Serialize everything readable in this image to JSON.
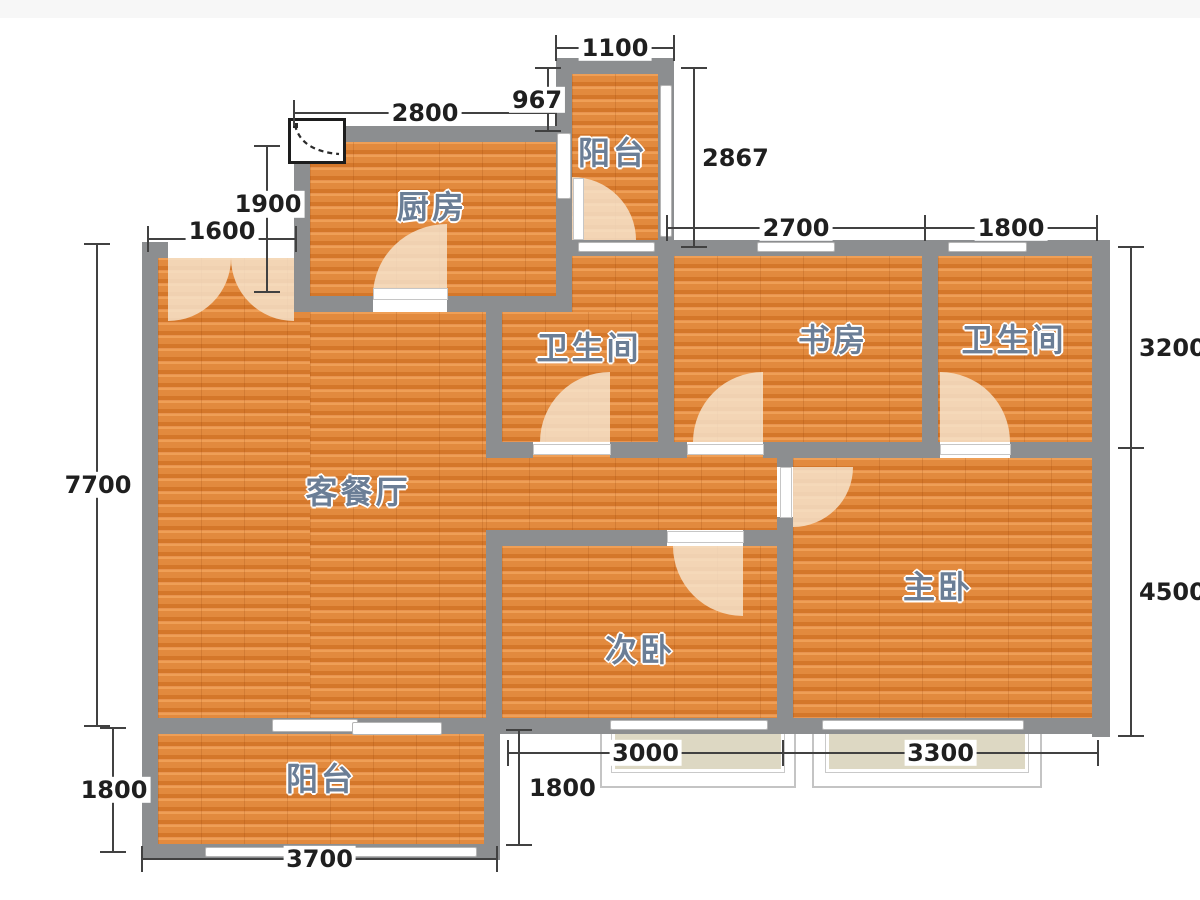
{
  "plan": {
    "rooms": [
      {
        "id": "kitchen",
        "label": "厨房"
      },
      {
        "id": "balcony-top",
        "label": "阳台"
      },
      {
        "id": "bathroom-left",
        "label": "卫生间"
      },
      {
        "id": "study",
        "label": "书房"
      },
      {
        "id": "bathroom-right",
        "label": "卫生间"
      },
      {
        "id": "living-dining",
        "label": "客餐厅"
      },
      {
        "id": "bedroom-second",
        "label": "次卧"
      },
      {
        "id": "bedroom-master",
        "label": "主卧"
      },
      {
        "id": "balcony-bottom",
        "label": "阳台"
      }
    ],
    "dimensions_mm": {
      "balcony_top_width": "1100",
      "kitchen_width": "2800",
      "kitchen_top_offset": "967",
      "balcony_top_height": "2867",
      "kitchen_side": "1900",
      "entry_opening": "1600",
      "study_width": "2700",
      "bathroom_right_width": "1800",
      "upper_right_depth": "3200",
      "living_side": "7700",
      "master_side": "4500",
      "balcony_bottom_side": "1800",
      "bedroom_second_width": "3000",
      "bedroom_master_width": "3300",
      "balcony_mid_side": "1800",
      "balcony_bottom_width": "3700"
    },
    "colors": {
      "wall": "#8c8e90",
      "floor": "#e0873c",
      "bay_fill": "#ddd8c3",
      "room_label": "#6b7e96",
      "dimension_text": "#1f1f1f",
      "door_arc": "#f6e3cb"
    }
  }
}
